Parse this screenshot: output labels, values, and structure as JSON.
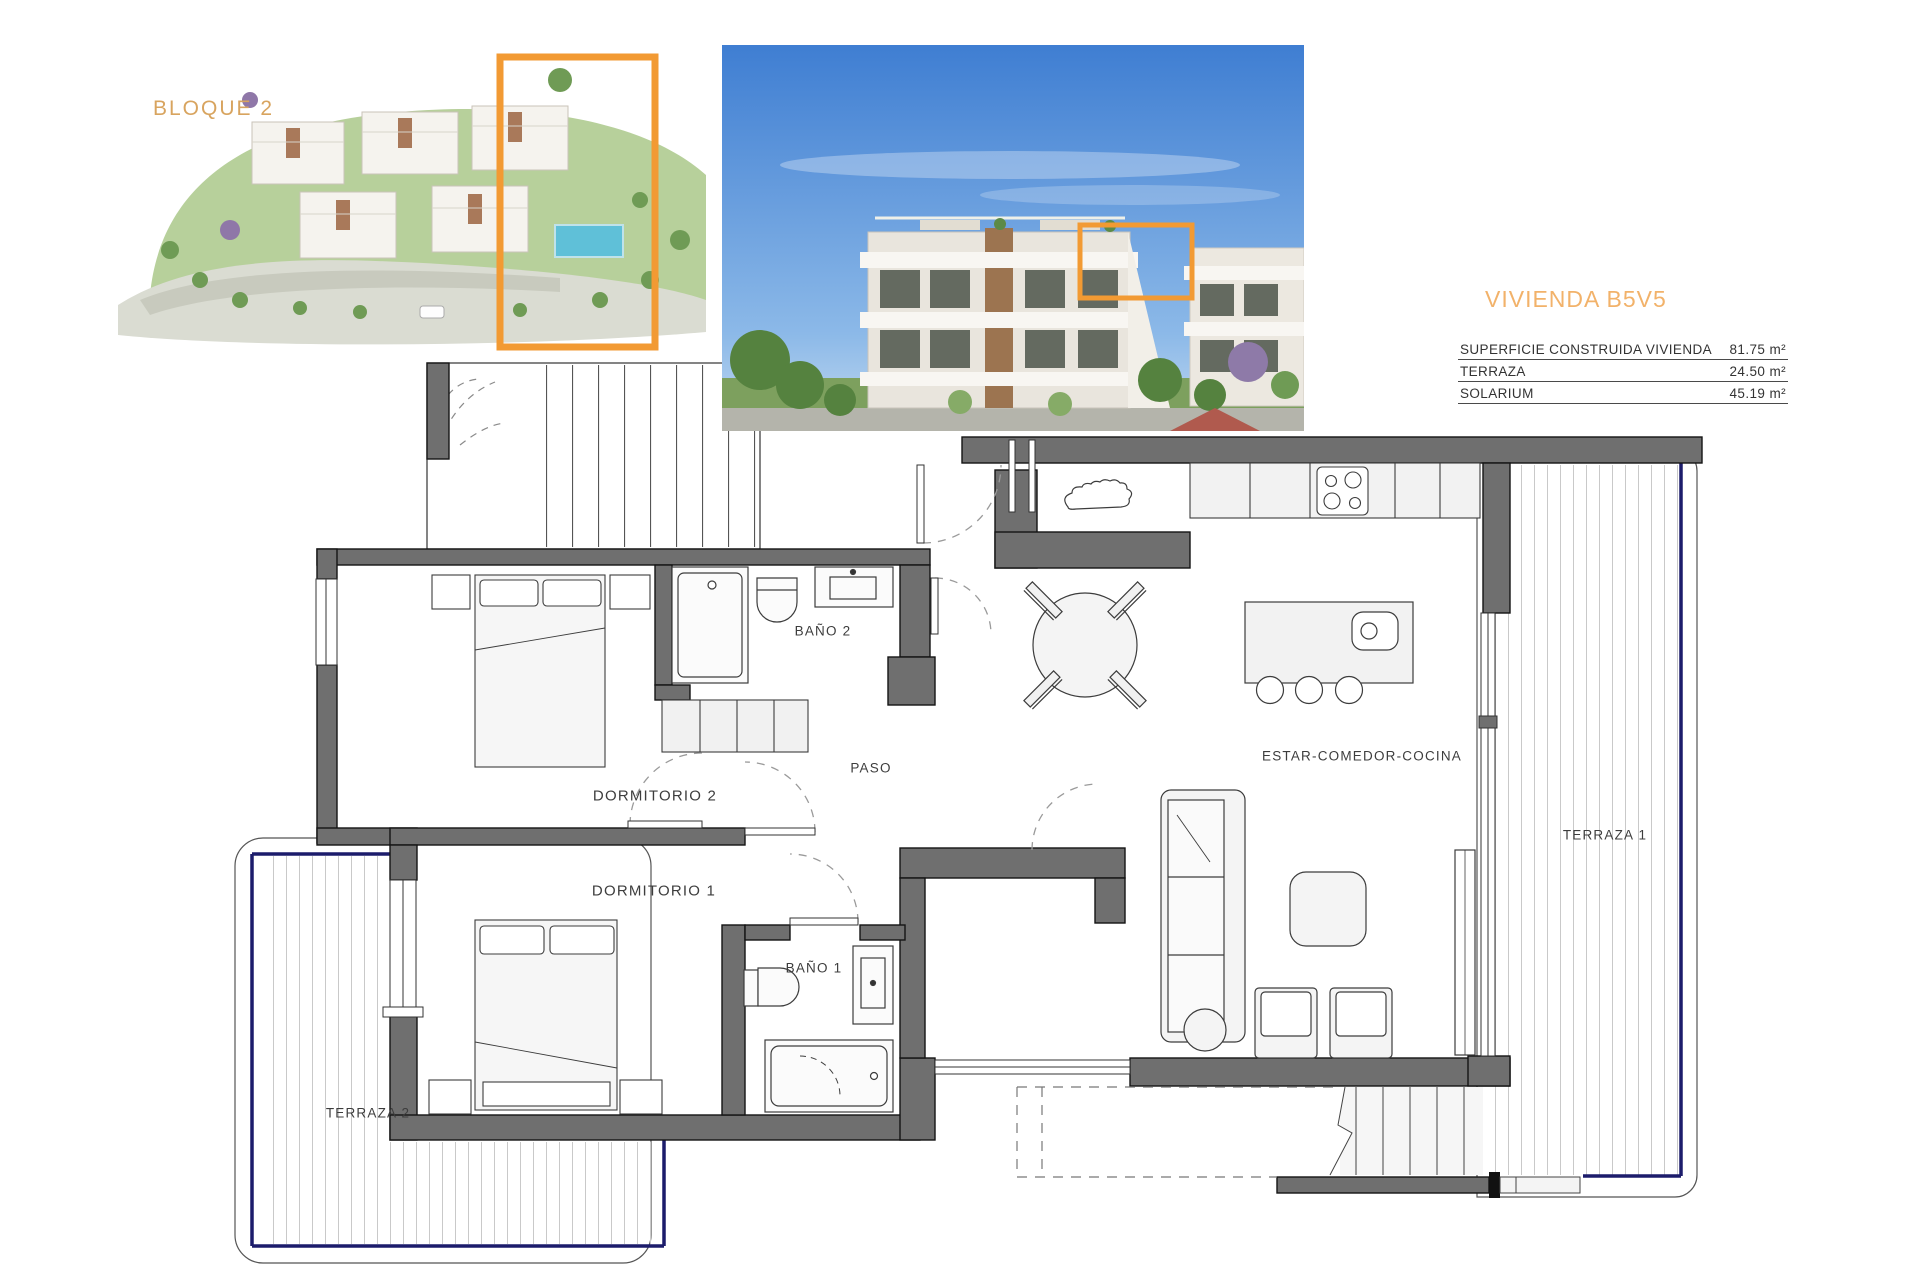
{
  "photos": {
    "aerial_label": "BLOQUE 2"
  },
  "unit": {
    "title": "VIVIENDA B5V5",
    "areas": [
      {
        "label": "SUPERFICIE CONSTRUIDA VIVIENDA",
        "value": "81.75 m²"
      },
      {
        "label": "TERRAZA",
        "value": "24.50 m²"
      },
      {
        "label": "SOLARIUM",
        "value": "45.19 m²"
      }
    ]
  },
  "plan": {
    "rooms": [
      {
        "id": "dormitorio-2",
        "label": "DORMITORIO 2"
      },
      {
        "id": "dormitorio-1",
        "label": "DORMITORIO 1"
      },
      {
        "id": "bano-2",
        "label": "BAÑO 2"
      },
      {
        "id": "bano-1",
        "label": "BAÑO 1"
      },
      {
        "id": "paso",
        "label": "PASO"
      },
      {
        "id": "estar-comedor-cocina",
        "label": "ESTAR-COMEDOR-COCINA"
      },
      {
        "id": "terraza-1",
        "label": "TERRAZA 1"
      },
      {
        "id": "terraza-2",
        "label": "TERRAZA 2"
      }
    ]
  },
  "colors": {
    "highlight": "#F29A33",
    "accent_text": "#E9A960",
    "navy": "#1C1C6B",
    "wall": "#6F6F6F"
  }
}
